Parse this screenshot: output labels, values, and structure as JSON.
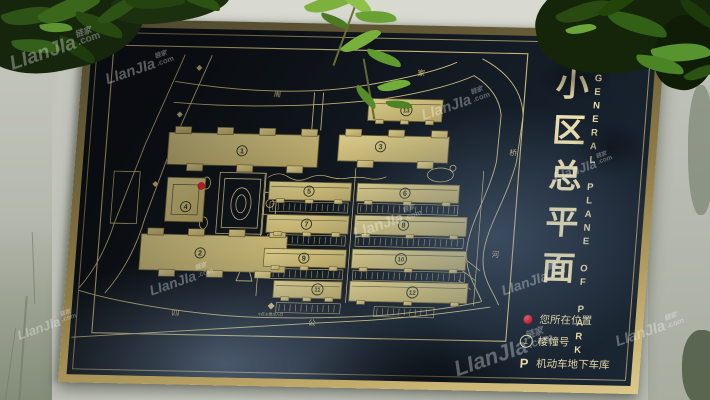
{
  "watermark": {
    "brand": "LIanJIa",
    "cn": "链家",
    "suffix": ".com"
  },
  "sign": {
    "title_cn": "小区总平面",
    "title_en": "GENERAL PLANE OF PARK",
    "legend": [
      {
        "type": "dot",
        "label": "您所在位置"
      },
      {
        "type": "circle-number",
        "number": "1",
        "label": "楼幢号"
      },
      {
        "type": "letter",
        "letter": "P",
        "label": "机动车地下车库"
      }
    ]
  },
  "map": {
    "colors": {
      "line": "#c9ba7b",
      "building_fill_light": "#d8ca8a",
      "building_fill_dark": "#b2a162",
      "building_edge": "#6e6136",
      "label_dark": "#2f3526",
      "red_dot": "#df232e"
    },
    "you_are_here": {
      "x": 118,
      "y": 153
    },
    "buildings": [
      {
        "num": "1",
        "type": "wings",
        "x": 82,
        "y": 100,
        "w": 150,
        "h": 32,
        "lx": 156,
        "ly": 117
      },
      {
        "num": "2",
        "type": "wings",
        "x": 62,
        "y": 202,
        "w": 146,
        "h": 36,
        "lx": 122,
        "ly": 220
      },
      {
        "num": "3",
        "type": "wings",
        "x": 252,
        "y": 99,
        "w": 110,
        "h": 26,
        "lx": 294,
        "ly": 110
      },
      {
        "num": "4",
        "type": "tower",
        "x": 84,
        "y": 145,
        "w": 38,
        "h": 44,
        "lx": 104,
        "ly": 174
      },
      {
        "num": "5",
        "type": "slab",
        "x": 186,
        "y": 147,
        "w": 82,
        "h": 18,
        "lx": 226,
        "ly": 156
      },
      {
        "num": "6",
        "type": "slab",
        "x": 274,
        "y": 147,
        "w": 102,
        "h": 18,
        "lx": 322,
        "ly": 156
      },
      {
        "num": "7",
        "type": "slab",
        "x": 186,
        "y": 180,
        "w": 82,
        "h": 18,
        "lx": 226,
        "ly": 189
      },
      {
        "num": "8",
        "type": "slab",
        "x": 274,
        "y": 179,
        "w": 112,
        "h": 19,
        "lx": 323,
        "ly": 188
      },
      {
        "num": "9",
        "type": "slab",
        "x": 186,
        "y": 214,
        "w": 82,
        "h": 18,
        "lx": 226,
        "ly": 223
      },
      {
        "num": "10",
        "type": "slab",
        "x": 274,
        "y": 213,
        "w": 114,
        "h": 19,
        "lx": 323,
        "ly": 222
      },
      {
        "num": "11",
        "type": "slab",
        "x": 198,
        "y": 246,
        "w": 68,
        "h": 17,
        "lx": 242,
        "ly": 254
      },
      {
        "num": "12",
        "type": "slab",
        "x": 274,
        "y": 245,
        "w": 118,
        "h": 20,
        "lx": 337,
        "ly": 255
      },
      {
        "num": "13",
        "type": "slab",
        "x": 279,
        "y": 62,
        "w": 74,
        "h": 22,
        "lx": 317,
        "ly": 73
      }
    ],
    "road_labels": [
      {
        "text": "周",
        "x": 187,
        "y": 62
      },
      {
        "text": "家",
        "x": 329,
        "y": 38
      },
      {
        "text": "桥",
        "x": 427,
        "y": 116
      },
      {
        "text": "河",
        "x": 417,
        "y": 218
      },
      {
        "text": "四",
        "x": 102,
        "y": 283
      },
      {
        "text": "公",
        "x": 239,
        "y": 290
      }
    ],
    "entrance_label": "小区主要出入口"
  }
}
